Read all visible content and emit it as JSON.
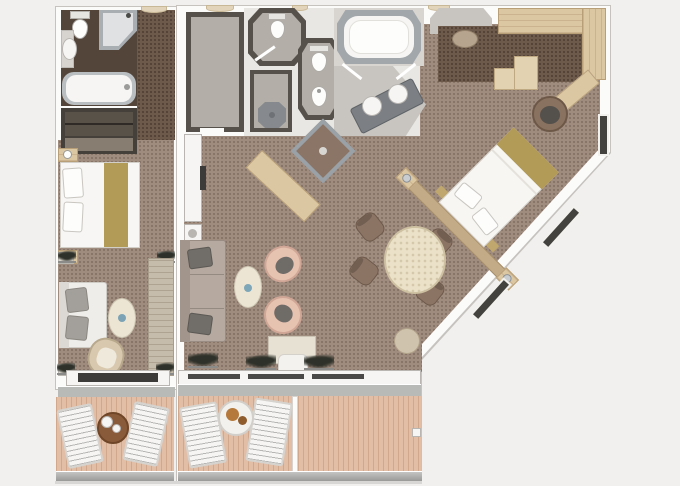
{
  "plan": {
    "description": "Top-down rendered floor plan of a luxury ship suite: a narrow connecting cabin on the left and a large main suite on the right with a diagonal seaward wall, private balconies with sun loungers along the bottom.",
    "rooms": [
      "guest-bathroom",
      "guest-corridor",
      "guest-closet",
      "guest-bedroom",
      "guest-living-area",
      "guest-balcony",
      "entry-hall",
      "walk-in-closet",
      "wc-room",
      "shower-room",
      "toilet-bidet-room",
      "spa-tub-room",
      "vanity-bathroom",
      "corner-shower-room",
      "master-wardrobe",
      "master-bedroom",
      "dining-area",
      "living-room",
      "main-balcony"
    ],
    "furniture": [
      "bathtub",
      "corner-shower",
      "toilet",
      "sink",
      "double-bed",
      "nightstand",
      "sofa",
      "coffee-table",
      "armchair",
      "console-cabinet",
      "tv",
      "sun-lounger",
      "balcony-table",
      "spa-bathtub",
      "twin-sink-vanity",
      "bidet",
      "shower-tray",
      "wardrobe-shelves",
      "ottoman",
      "step-dresser",
      "desk",
      "desk-chair",
      "king-bed",
      "headboard",
      "dining-table",
      "dining-chair",
      "pouf",
      "tub-chair",
      "bar-table",
      "window",
      "plant",
      "railing"
    ]
  },
  "colors": {
    "background": "#f1f0ee",
    "wall_white": "#fbfbfa",
    "wall_line": "#c6c3bf",
    "wall_dark": "#56514b",
    "carpet": "#a08c7f",
    "carpet_dark": "#6d5a4b",
    "closet_floor": "#46403a",
    "bath_floor_dark": "#53453a",
    "bath_floor_gray": "#b3afa8",
    "hall_floor": "#e9e7e3",
    "gray_floor": "#c8c5c0",
    "fixture_white": "#f6f5f3",
    "fixture_rim": "#a2a7ab",
    "wood": "#dcc7a3",
    "wood_dark": "#b89f78",
    "deck": "#e2bea6",
    "railing": "#9a9a98",
    "sofa_light": "#efedea",
    "sofa_main": "#b5a9a0",
    "pillow_gray": "#a39f9a",
    "pillow_dark": "#716d69",
    "chair_pink": "#e6c2b1",
    "cushion_dark": "#6f6b67",
    "cream_table": "#ece5d4",
    "dining_table": "#eae1c8",
    "dining_chair": "#8b7464",
    "bed_runner": "#b29a57",
    "pouf": "#cfc3ad",
    "ottoman_taupe": "#b7a48e",
    "glass_dark": "#44423f",
    "plant": "#2e3129",
    "balcony_table_brown": "#8a5b3b",
    "food_tan": "#b5793b",
    "silver": "#c9cdd0",
    "armchair_beige": "#d8c8ae",
    "console": "#c6bcab",
    "door_beige": "#e2d4ba",
    "threshold": "#b7bab6",
    "desk_white": "#e7e1d4"
  }
}
